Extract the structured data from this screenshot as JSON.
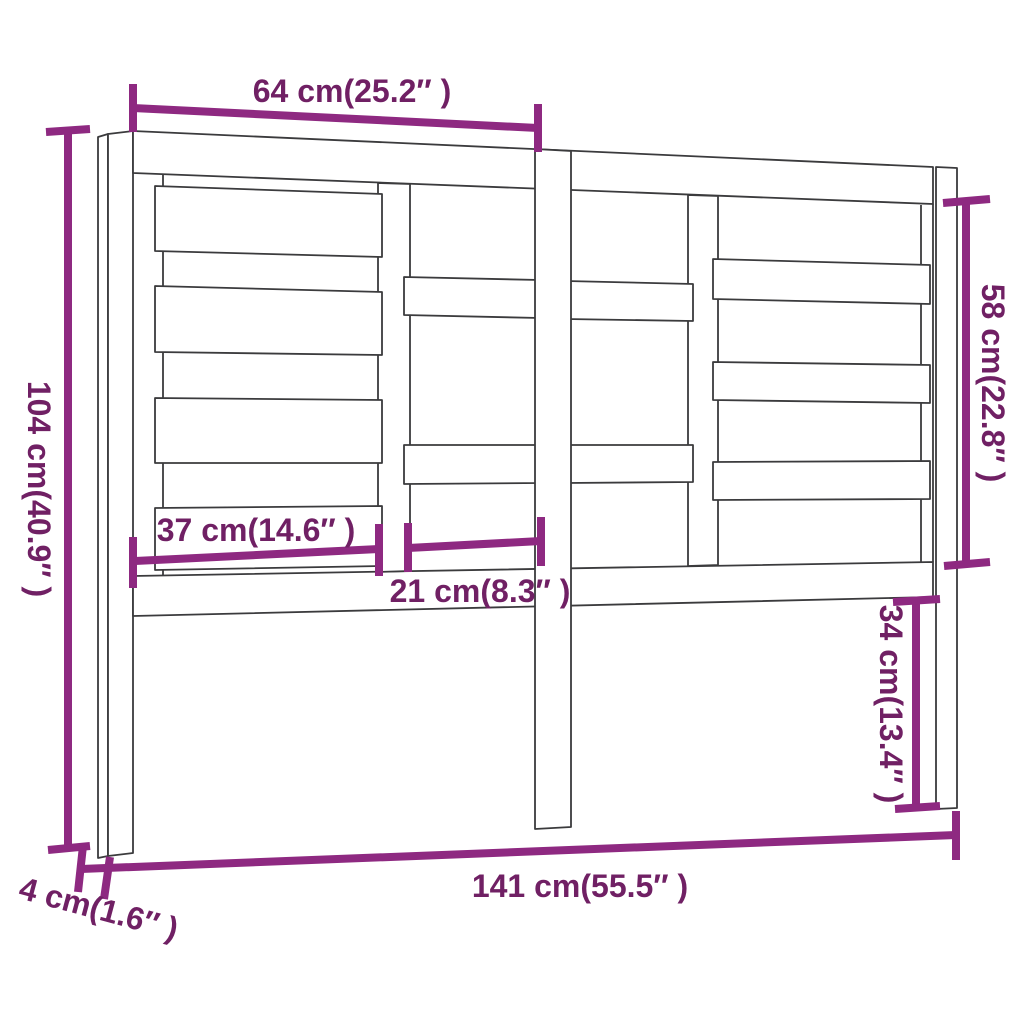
{
  "diagram": {
    "kind": "furniture-dimension-diagram",
    "units": [
      "cm",
      "inch"
    ]
  },
  "colors": {
    "background": "#ffffff",
    "dimension_line": "#8e2981",
    "dimension_text": "#702064",
    "drawing_outline": "#3b3b3d"
  },
  "dimensions": {
    "top_width": {
      "cm": 64,
      "inch": 25.2,
      "label": "64 cm(25.2″ )"
    },
    "overall_height": {
      "cm": 104,
      "inch": 40.9,
      "label": "104 cm(40.9″ )"
    },
    "upper_right_height": {
      "cm": 58,
      "inch": 22.8,
      "label": "58 cm(22.8″ )"
    },
    "left_panel_width": {
      "cm": 37,
      "inch": 14.6,
      "label": "37 cm(14.6″ )"
    },
    "center_panel_width": {
      "cm": 21,
      "inch": 8.3,
      "label": "21 cm(8.3″ )"
    },
    "lower_right_height": {
      "cm": 34,
      "inch": 13.4,
      "label": "34 cm(13.4″ )"
    },
    "overall_width": {
      "cm": 141,
      "inch": 55.5,
      "label": "141 cm(55.5″ )"
    },
    "leg_thickness": {
      "cm": 4,
      "inch": 1.6,
      "label": "4 cm(1.6″ )"
    }
  }
}
